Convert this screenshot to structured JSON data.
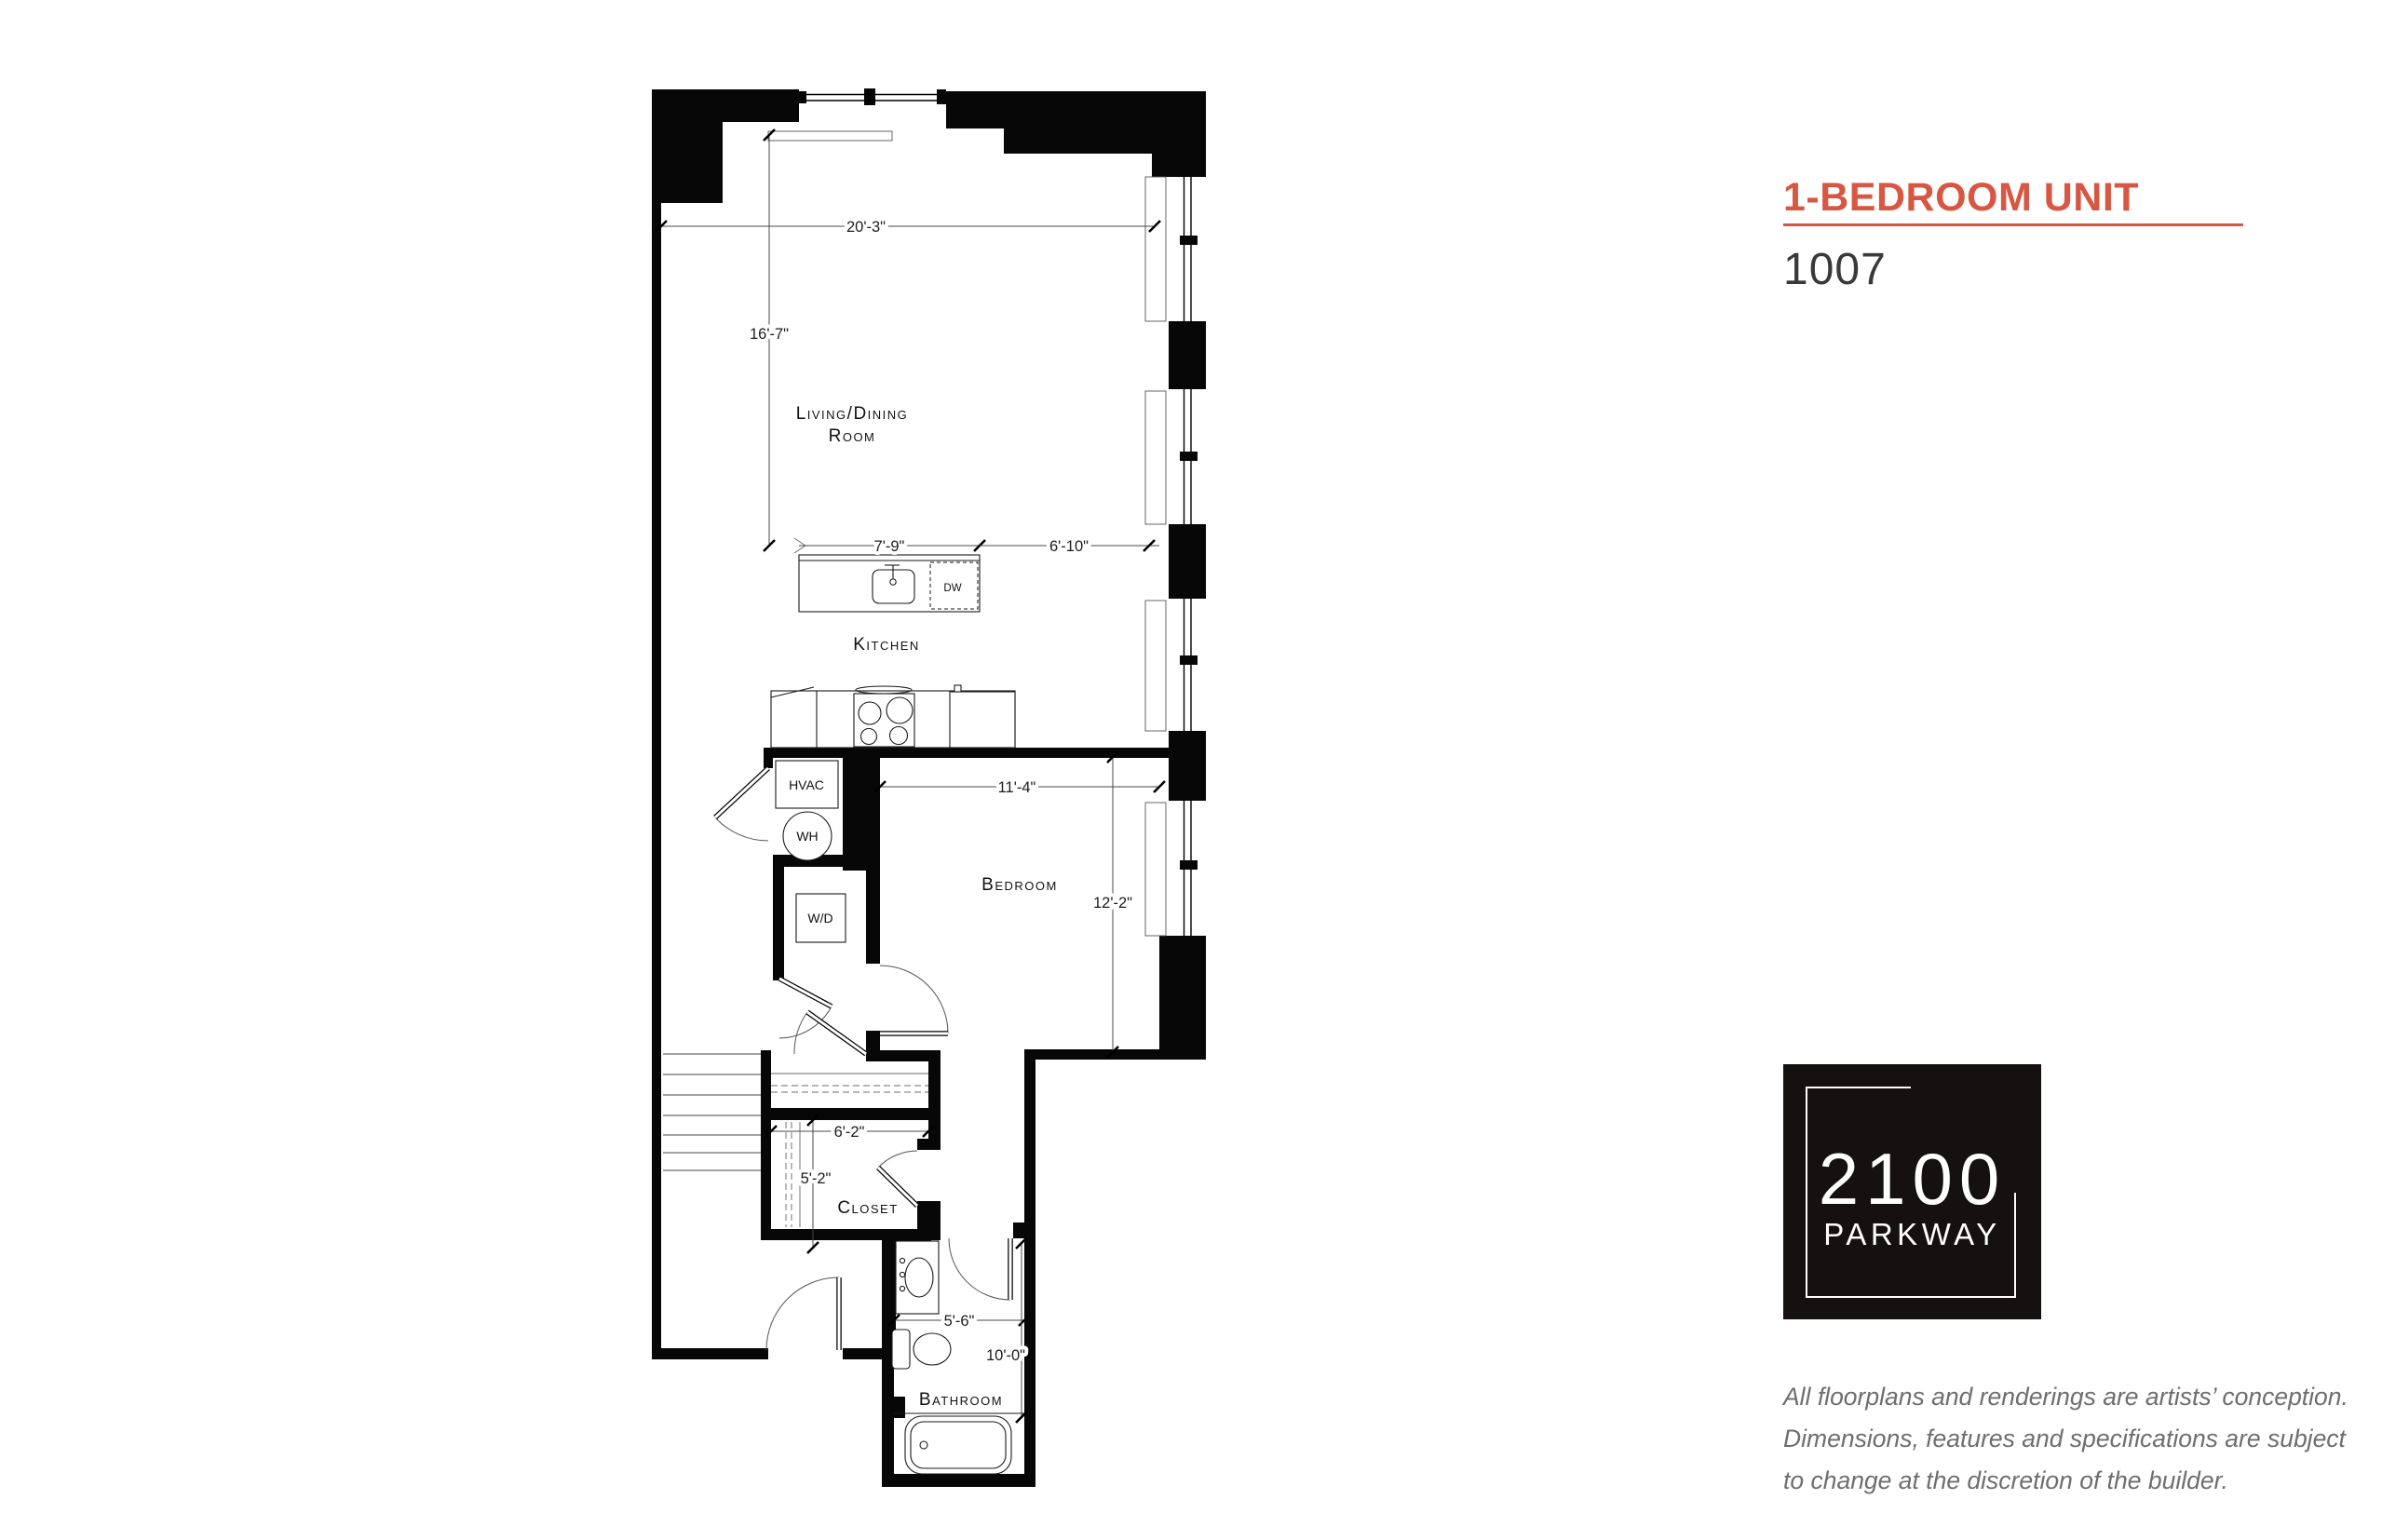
{
  "header": {
    "title": "1-BEDROOM UNIT",
    "unit_number": "1007",
    "accent_color": "#d75743"
  },
  "floorplan": {
    "rooms": {
      "living_line1": "Living/Dining",
      "living_line2": "Room",
      "kitchen": "Kitchen",
      "bedroom": "Bedroom",
      "closet": "Closet",
      "bathroom": "Bathroom"
    },
    "equipment": {
      "hvac": "HVAC",
      "water_heater": "WH",
      "washer_dryer": "W/D",
      "dishwasher": "DW"
    },
    "dimensions": {
      "living_width": "20'-3\"",
      "living_depth": "16'-7\"",
      "island_width": "7'-9\"",
      "kitchen_clear": "6'-10\"",
      "bedroom_width": "11'-4\"",
      "bedroom_depth": "12'-2\"",
      "closet_width": "6'-2\"",
      "closet_depth": "5'-2\"",
      "bathroom_width": "5'-6\"",
      "bathroom_depth": "10'-0\""
    }
  },
  "logo": {
    "line1": "2100",
    "line2": "PARKWAY",
    "bg_color": "#141110"
  },
  "disclaimer": {
    "line1": "All floorplans and renderings are artists’ conception.",
    "line2": "Dimensions, features and specifications are subject",
    "line3": "to change at the discretion of the builder."
  }
}
